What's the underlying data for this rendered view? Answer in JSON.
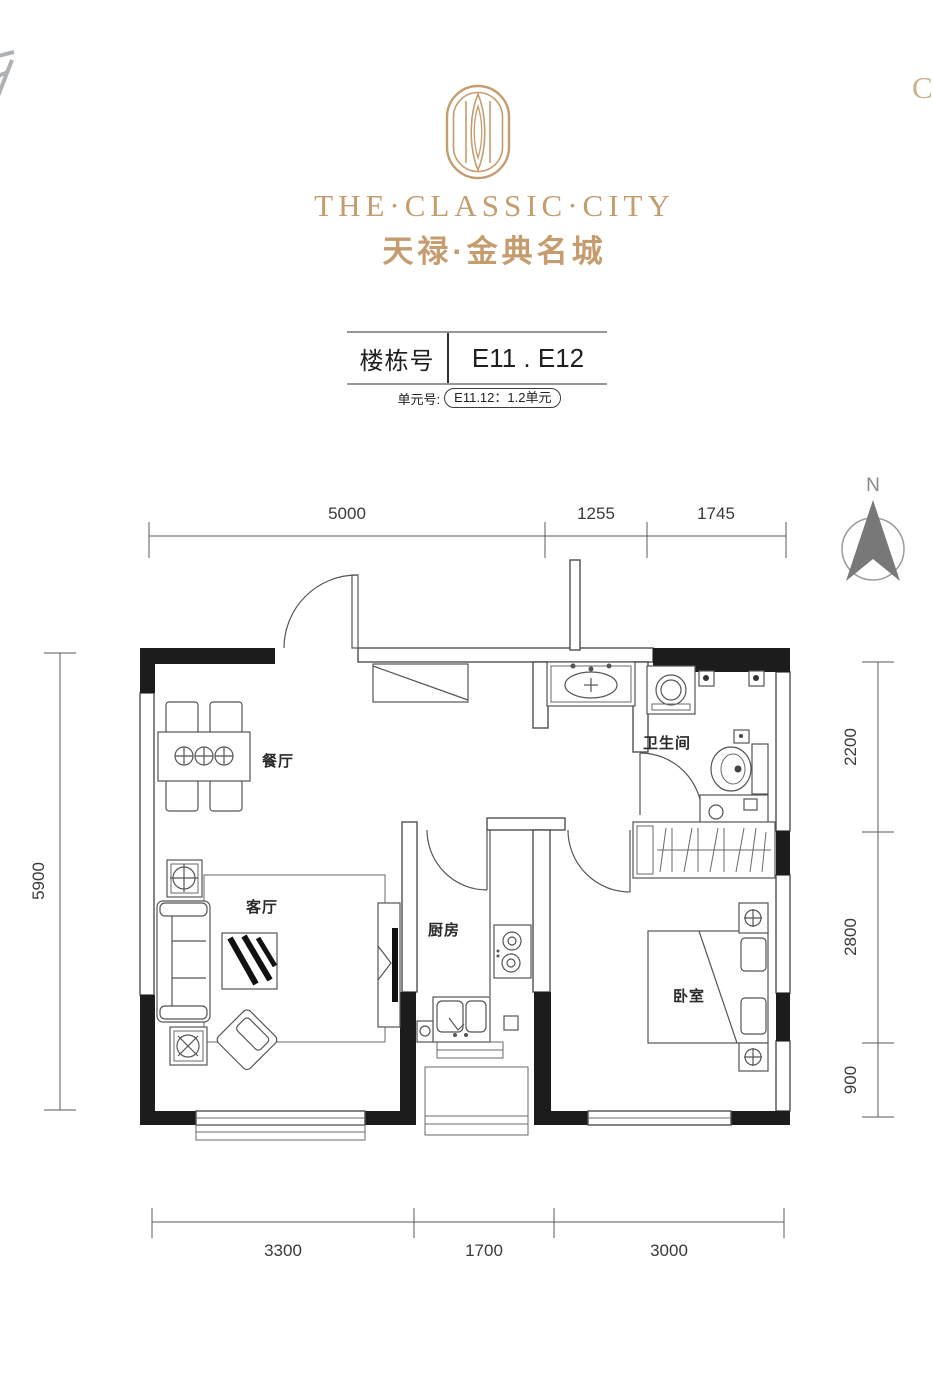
{
  "brand": {
    "title_en": "THE·CLASSIC·CITY",
    "title_cn": "天禄·金典名城",
    "logo_icon": "stadium-monogram-icon"
  },
  "building": {
    "label": "楼栋号",
    "value": "E11 . E12"
  },
  "unit": {
    "label": "单元号:",
    "value": "E11.12：1.2单元"
  },
  "compass": {
    "label": "N"
  },
  "rooms": [
    {
      "name": "餐厅"
    },
    {
      "name": "客厅"
    },
    {
      "name": "厨房"
    },
    {
      "name": "卫生间"
    },
    {
      "name": "卧室"
    }
  ],
  "dimensions": {
    "top": [
      "5000",
      "1255",
      "1745"
    ],
    "bottom": [
      "3300",
      "1700",
      "3000"
    ],
    "left": [
      "5900"
    ],
    "right": [
      "2200",
      "2800",
      "900"
    ]
  },
  "watermark": {
    "right_edge": "C"
  },
  "colors": {
    "gold": "#C59C6E",
    "wall_black": "#1C1C1C",
    "line_gray": "#4F4F4F"
  }
}
